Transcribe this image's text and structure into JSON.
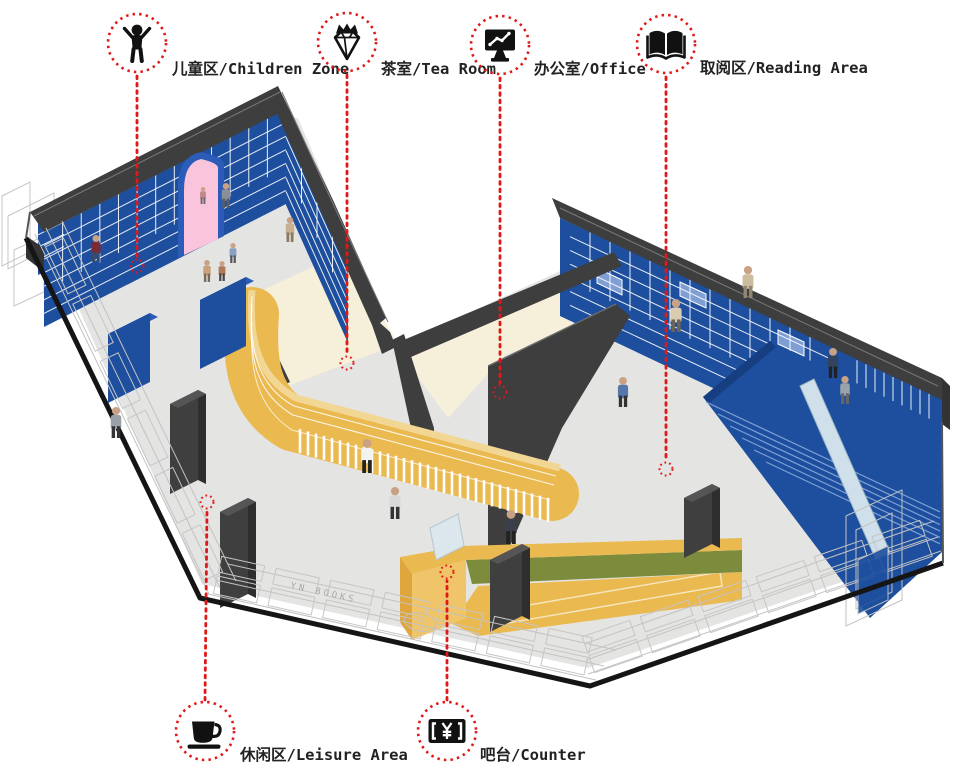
{
  "diagram_title": "bookstore-axonometric-zone-diagram",
  "palette": {
    "accent_red": "#e01818",
    "wall_blue": "#1d4f9e",
    "shelf_yellow": "#eab950",
    "counter_olive": "#7d8c3c",
    "door_pink": "#f9c4dc",
    "wall_dark": "#3e3e3e",
    "floor_gray": "#e4e4e3",
    "floor_cream": "#f6efd9",
    "ramp_pale_blue": "#cfe0ea"
  },
  "storefront_sign": "YN BOOKS",
  "legend": {
    "items": [
      {
        "id": "children-zone",
        "icon": "child-icon",
        "label": "儿童区/Children Zone",
        "circle": {
          "cx": 137,
          "cy": 43
        },
        "label_pos": {
          "x": 172,
          "y": 74
        },
        "leader": {
          "x1": 137,
          "y1": 76,
          "x2": 137,
          "y2": 257
        },
        "target": {
          "cx": 137,
          "cy": 266
        }
      },
      {
        "id": "tea-room",
        "icon": "gem-icon",
        "label": "茶室/Tea Room",
        "circle": {
          "cx": 347,
          "cy": 42
        },
        "label_pos": {
          "x": 381,
          "y": 74
        },
        "leader": {
          "x1": 347,
          "y1": 75,
          "x2": 347,
          "y2": 354
        },
        "target": {
          "cx": 347,
          "cy": 363
        }
      },
      {
        "id": "office",
        "icon": "monitor-icon",
        "label": "办公室/Office",
        "circle": {
          "cx": 500,
          "cy": 45
        },
        "label_pos": {
          "x": 534,
          "y": 74
        },
        "leader": {
          "x1": 500,
          "y1": 78,
          "x2": 500,
          "y2": 383
        },
        "target": {
          "cx": 500,
          "cy": 392
        }
      },
      {
        "id": "reading-area",
        "icon": "book-icon",
        "label": "取阅区/Reading Area",
        "circle": {
          "cx": 666,
          "cy": 44
        },
        "label_pos": {
          "x": 700,
          "y": 73
        },
        "leader": {
          "x1": 666,
          "y1": 77,
          "x2": 666,
          "y2": 460
        },
        "target": {
          "cx": 666,
          "cy": 469
        }
      },
      {
        "id": "leisure-area",
        "icon": "cup-icon",
        "label": "休闲区/Leisure Area",
        "circle": {
          "cx": 205,
          "cy": 731
        },
        "label_pos": {
          "x": 240,
          "y": 760
        },
        "leader": {
          "x1": 205,
          "y1": 700,
          "x2": 207,
          "y2": 511
        },
        "target": {
          "cx": 207,
          "cy": 502
        }
      },
      {
        "id": "counter",
        "icon": "yen-icon",
        "label": "吧台/Counter",
        "circle": {
          "cx": 447,
          "cy": 731
        },
        "label_pos": {
          "x": 480,
          "y": 760
        },
        "leader": {
          "x1": 447,
          "y1": 700,
          "x2": 447,
          "y2": 581
        },
        "target": {
          "cx": 447,
          "cy": 572
        }
      }
    ]
  },
  "people": [
    {
      "x": 96,
      "y": 262,
      "h": 27,
      "top": "#7a2a32",
      "bottom": "#3a4a68"
    },
    {
      "x": 207,
      "y": 282,
      "h": 22,
      "top": "#c9a27a",
      "bottom": "#7a6a55"
    },
    {
      "x": 233,
      "y": 263,
      "h": 20,
      "top": "#8aa0c0",
      "bottom": "#555555"
    },
    {
      "x": 222,
      "y": 281,
      "h": 20,
      "top": "#b0785a",
      "bottom": "#444444"
    },
    {
      "x": 203,
      "y": 204,
      "h": 17,
      "top": "#c08a8a",
      "bottom": "#666666"
    },
    {
      "x": 226,
      "y": 208,
      "h": 25,
      "top": "#8a8f98",
      "bottom": "#5a5f66"
    },
    {
      "x": 290,
      "y": 242,
      "h": 25,
      "top": "#c9b090",
      "bottom": "#8a7a60"
    },
    {
      "x": 116,
      "y": 438,
      "h": 31,
      "top": "#9aa0a8",
      "bottom": "#333333"
    },
    {
      "x": 367,
      "y": 473,
      "h": 34,
      "top": "#f2f2f2",
      "bottom": "#222222"
    },
    {
      "x": 395,
      "y": 519,
      "h": 32,
      "top": "#d8d8d8",
      "bottom": "#333333"
    },
    {
      "x": 511,
      "y": 544,
      "h": 34,
      "top": "#3a3f4a",
      "bottom": "#222222"
    },
    {
      "x": 748,
      "y": 298,
      "h": 32,
      "top": "#cdbd9e",
      "bottom": "#8f8570"
    },
    {
      "x": 676,
      "y": 332,
      "h": 33,
      "top": "#d8cdb0",
      "bottom": "#6b6355"
    },
    {
      "x": 623,
      "y": 407,
      "h": 30,
      "top": "#5577aa",
      "bottom": "#333333"
    },
    {
      "x": 833,
      "y": 378,
      "h": 30,
      "top": "#31435e",
      "bottom": "#222222"
    },
    {
      "x": 845,
      "y": 404,
      "h": 28,
      "top": "#9aa2ac",
      "bottom": "#666666"
    }
  ]
}
